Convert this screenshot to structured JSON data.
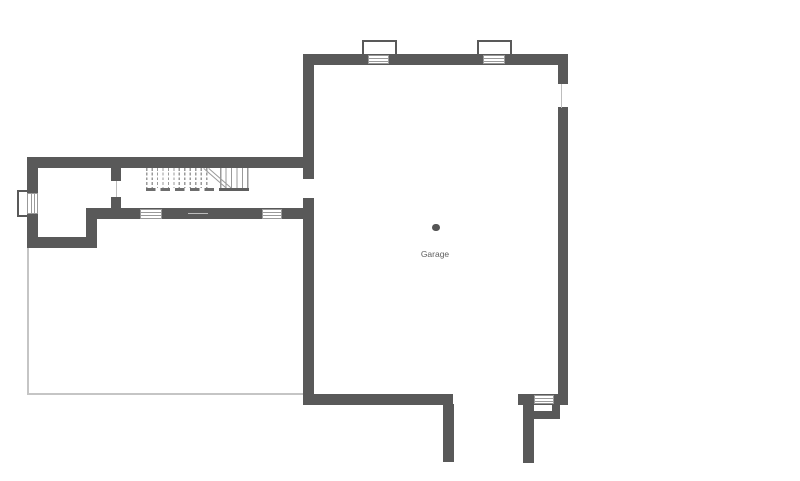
{
  "plan": {
    "rooms": [
      {
        "name": "Garage",
        "label": "Garage"
      }
    ],
    "labels": {
      "garage": "Garage"
    },
    "features": [
      "staircase-with-break-line",
      "hidden-stair-treads-dashed",
      "window-with-well-left",
      "box-window-top-1",
      "box-window-top-2",
      "window-south-wall-1",
      "window-south-wall-2",
      "window-right-wall",
      "window-bottom-right",
      "door-opening-hall",
      "door-opening-garage",
      "wall-opening-south",
      "garage-door-opening",
      "column-marker-dot",
      "unfinished-area-thin-outline"
    ],
    "colors": {
      "background": "#ffffff",
      "wall": "#595959",
      "thin_outline": "#c5c5c5",
      "window_line": "#999999",
      "opening_line": "#bdbdbd",
      "stair_line": "#9a9a9a",
      "stair_dash": "#6e6e6e",
      "stair_edge": "#5f5f5f",
      "column_dot": "#555555",
      "label_text": "#5f5f5f"
    }
  }
}
